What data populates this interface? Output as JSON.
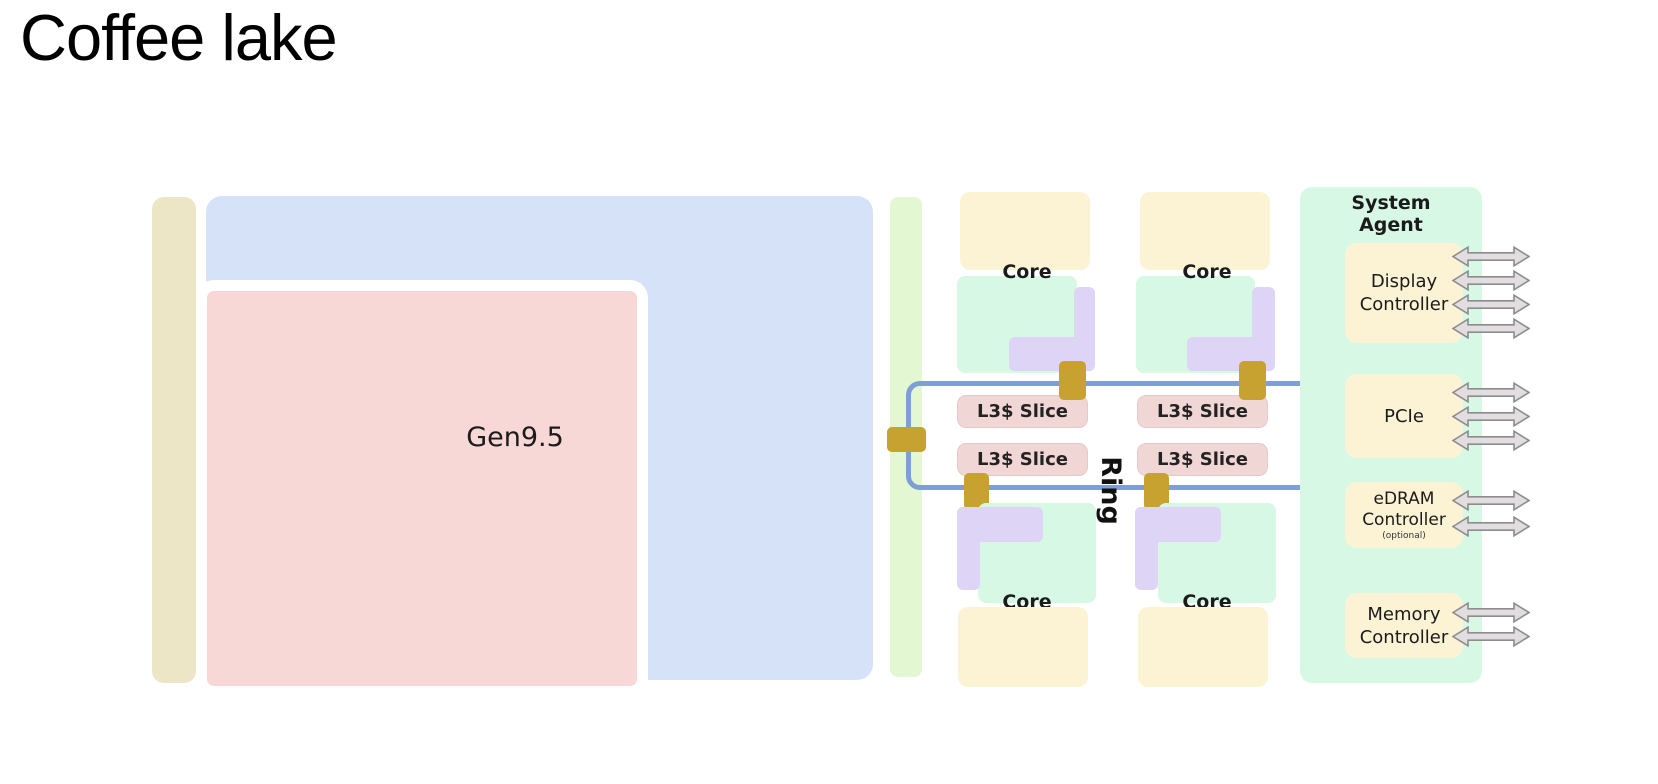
{
  "title": "Coffee lake",
  "diagram": {
    "gpu": {
      "label": "Gen9.5"
    },
    "core_label": "Core",
    "l3_slice_label": "L3$ Slice",
    "ring_label": "Ring",
    "system_agent": {
      "title": "System\nAgent",
      "display": {
        "label": "Display\nController",
        "arrow_count": 4
      },
      "pcie": {
        "label": "PCIe",
        "arrow_count": 3
      },
      "edram": {
        "label": "eDRAM\nController",
        "note": "(optional)",
        "arrow_count": 2
      },
      "memory": {
        "label": "Memory\nController",
        "arrow_count": 2
      }
    },
    "colors": {
      "outer_bar": "#ece6c6",
      "gpu_container": "#d6e2f8",
      "gpu_block": "#f8d8d6",
      "inner_strip": "#e2f7d2",
      "core_block": "#d7f8e5",
      "core_cap": "#fcf3d4",
      "core_l2": "#ddd4f6",
      "l3_slice": "#f1d6d6",
      "ring": "#7e9fd6",
      "ring_stop": "#c7a230",
      "system_agent_bg": "#d7f8e4",
      "io_block": "#fcf3d4",
      "arrow_fill": "#e2dde1",
      "arrow_stroke": "#8d8d8d",
      "title_text": "#000000",
      "label_text": "#1b1b1b"
    }
  }
}
